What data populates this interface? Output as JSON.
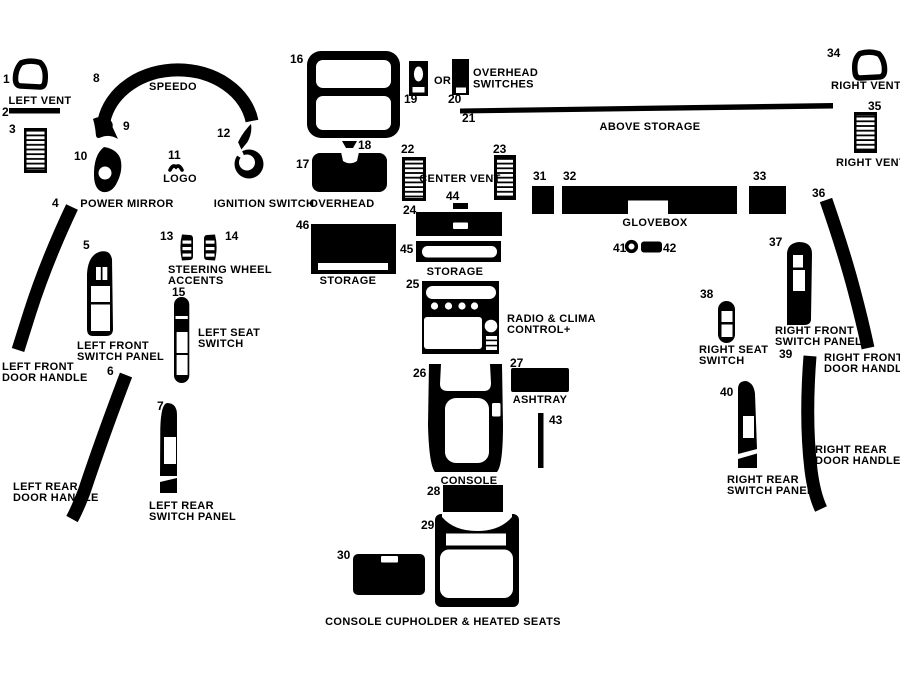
{
  "colors": {
    "ink": "#000000",
    "paper": "#ffffff"
  },
  "numbers": [
    "1",
    "2",
    "3",
    "4",
    "5",
    "6",
    "7",
    "8",
    "9",
    "10",
    "11",
    "12",
    "13",
    "14",
    "15",
    "16",
    "17",
    "18",
    "19",
    "20",
    "21",
    "22",
    "23",
    "24",
    "25",
    "26",
    "27",
    "28",
    "29",
    "30",
    "31",
    "32",
    "33",
    "34",
    "35",
    "36",
    "37",
    "38",
    "39",
    "40",
    "41",
    "42",
    "43",
    "44",
    "45",
    "46"
  ],
  "labels": {
    "left_vent": "LEFT VENT",
    "speedo": "SPEEDO",
    "power_mirror": "POWER MIRROR",
    "logo": "LOGO",
    "ignition_switch": "IGNITION SWITCH",
    "or": "OR",
    "overhead_switches": [
      "OVERHEAD",
      "SWITCHES"
    ],
    "above_storage": "ABOVE STORAGE",
    "right_vent_upper": "RIGHT VENT",
    "right_vent_lower": "RIGHT VENT",
    "overhead": "OVERHEAD",
    "center_vent": "CENTER VENT",
    "glovebox": "GLOVEBOX",
    "steering_wheel_accents": [
      "STEERING WHEEL",
      "ACCENTS"
    ],
    "left_seat_switch": [
      "LEFT SEAT",
      "SWITCH"
    ],
    "left_front_switch_panel": [
      "LEFT FRONT",
      "SWITCH PANEL"
    ],
    "left_front_door_handle": [
      "LEFT FRONT",
      "DOOR HANDLE"
    ],
    "left_rear_door_handle": [
      "LEFT REAR",
      "DOOR HANDLE"
    ],
    "left_rear_switch_panel": [
      "LEFT REAR",
      "SWITCH PANEL"
    ],
    "storage_left": "STORAGE",
    "storage_center": "STORAGE",
    "radio_clima_control": [
      "RADIO &  CLIMA",
      "CONTROL+"
    ],
    "console": "CONSOLE",
    "ashtray": "ASHTRAY",
    "right_seat_switch": [
      "RIGHT SEAT",
      "SWITCH"
    ],
    "right_front_switch_panel": [
      "RIGHT FRONT",
      "SWITCH PANEL"
    ],
    "right_front_door_handle": [
      "RIGHT FRONT",
      "DOOR HANDLE"
    ],
    "right_rear_switch_panel": [
      "RIGHT REAR",
      "SWITCH PANEL"
    ],
    "right_rear_door_handle": [
      "RIGHT REAR",
      "DOOR HANDLE"
    ],
    "console_cupholder": "CONSOLE CUPHOLDER & HEATED SEATS"
  }
}
